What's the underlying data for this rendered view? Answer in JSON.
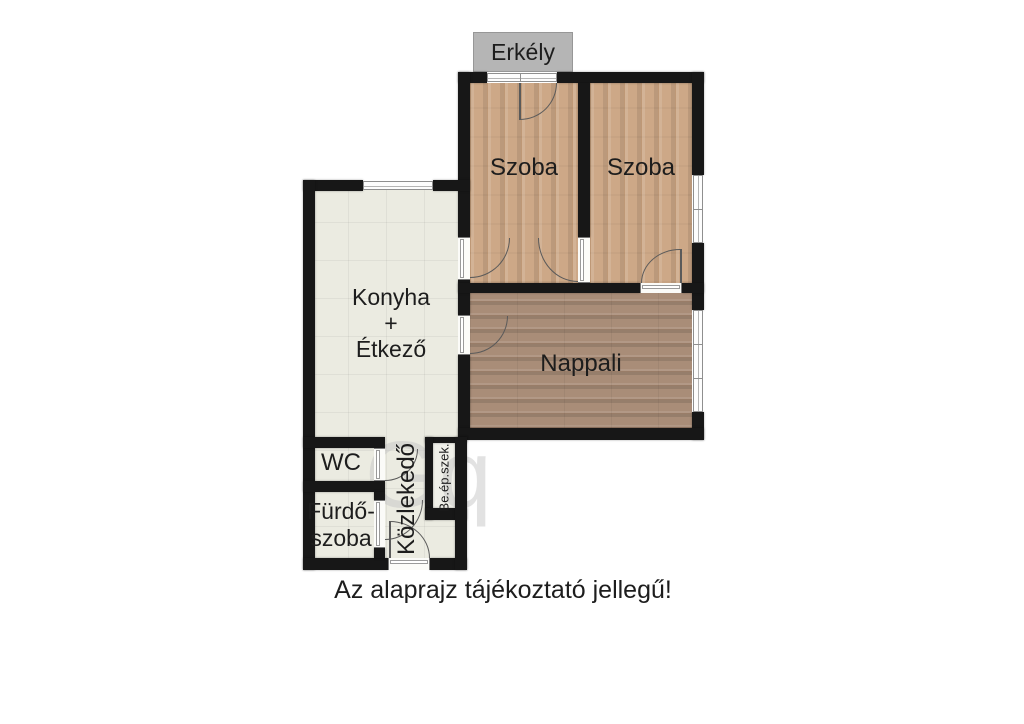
{
  "disclaimer": "Az alaprajz tájékoztató jellegű!",
  "watermark": "Gq",
  "colors": {
    "wall": "#171717",
    "balcony_bg": "#b5b5b5",
    "balcony_border": "#979797",
    "tile_floor": "#ebebe1",
    "wood_light": "#cda887",
    "wood_dark": "#a98d78",
    "door_arc": "#5a5a5a",
    "window_frame": "#8f8f8f",
    "label_text": "#1d1d1d"
  },
  "rooms": {
    "erkely": {
      "label": "Erkély"
    },
    "szoba1": {
      "label": "Szoba"
    },
    "szoba2": {
      "label": "Szoba"
    },
    "konyha": {
      "line1": "Konyha",
      "line2": "+",
      "line3": "Étkező"
    },
    "nappali": {
      "label": "Nappali"
    },
    "wc": {
      "label": "WC"
    },
    "furdoszoba": {
      "line1": "Fürdő-",
      "line2": "szoba"
    },
    "kozlekedo": {
      "label": "Közlekedő"
    },
    "beepitett_szekreny": {
      "label": "Be.ép.szek."
    }
  }
}
